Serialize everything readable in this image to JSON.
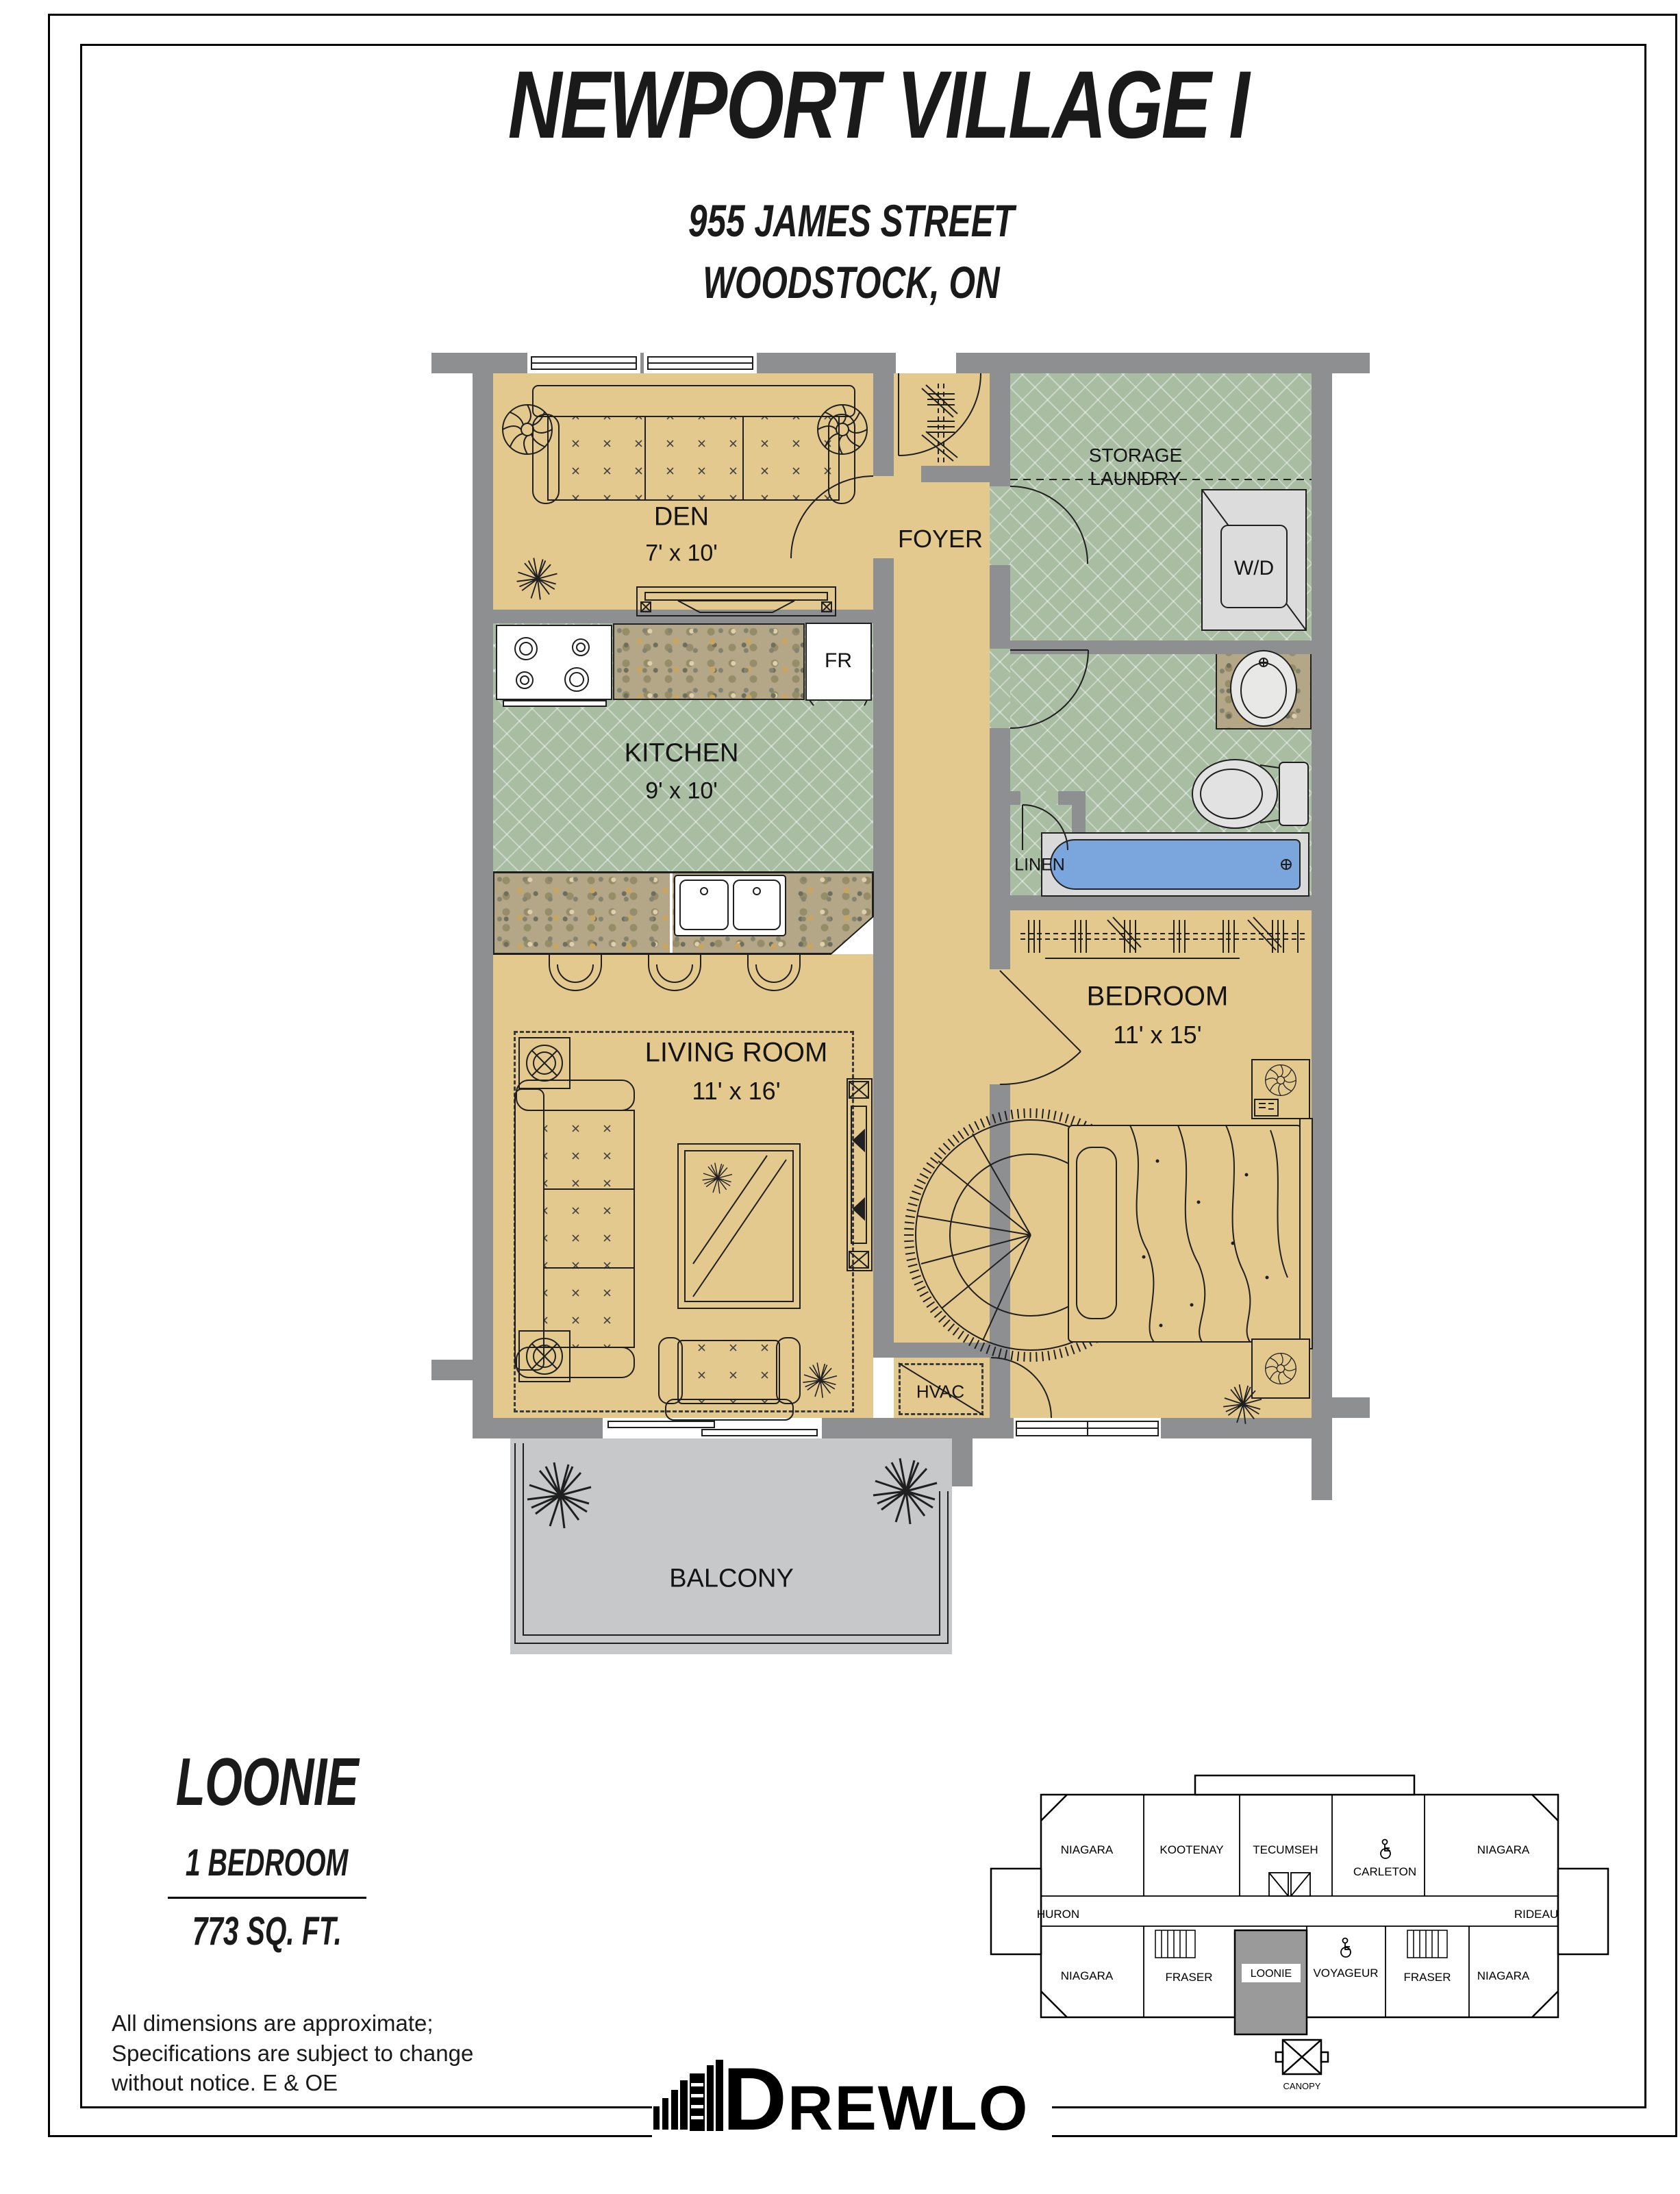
{
  "page": {
    "title": "NEWPORT VILLAGE I",
    "address_line1": "955 JAMES STREET",
    "address_line2": "WOODSTOCK, ON"
  },
  "rooms": {
    "den": {
      "name": "DEN",
      "dims": "7' x 10'"
    },
    "foyer": {
      "name": "FOYER"
    },
    "storage": {
      "line1": "STORAGE",
      "line2": "LAUNDRY"
    },
    "kitchen": {
      "name": "KITCHEN",
      "dims": "9' x 10'"
    },
    "linen": {
      "name": "LINEN"
    },
    "bedroom": {
      "name": "BEDROOM",
      "dims": "11' x 15'"
    },
    "living_room": {
      "name": "LIVING ROOM",
      "dims": "11' x 16'"
    },
    "hvac": {
      "name": "HVAC"
    },
    "balcony": {
      "name": "BALCONY"
    }
  },
  "appliances": {
    "fridge": "FR",
    "washer_dryer": "W/D"
  },
  "unit_info": {
    "name": "LOONIE",
    "type": "1 BEDROOM",
    "area": "773 SQ. FT."
  },
  "disclaimer": {
    "line1": "All dimensions are approximate;",
    "line2": "Specifications are subject to change",
    "line3": "without notice. E & OE"
  },
  "keyplan": {
    "units": [
      {
        "label": "NIAGARA"
      },
      {
        "label": "KOOTENAY"
      },
      {
        "label": "TECUMSEH"
      },
      {
        "label": "CARLETON"
      },
      {
        "label": "NIAGARA"
      },
      {
        "label": "HURON"
      },
      {
        "label": "RIDEAU"
      },
      {
        "label": "NIAGARA"
      },
      {
        "label": "FRASER"
      },
      {
        "label": "LOONIE"
      },
      {
        "label": "VOYAGEUR"
      },
      {
        "label": "FRASER"
      },
      {
        "label": "NIAGARA"
      }
    ],
    "canopy": "CANOPY",
    "highlighted_unit": "LOONIE"
  },
  "logo": {
    "d": "D",
    "rest": "REWLO",
    "full": "DREWLO"
  },
  "colors": {
    "floor_tan": "#e4c98f",
    "tile_green": "#a9bda3",
    "wall_gray": "#8d8f91",
    "balcony_gray": "#c7c8ca",
    "tub_blue": "#7aa6dd",
    "highlight_gray": "#9a9a9a"
  }
}
